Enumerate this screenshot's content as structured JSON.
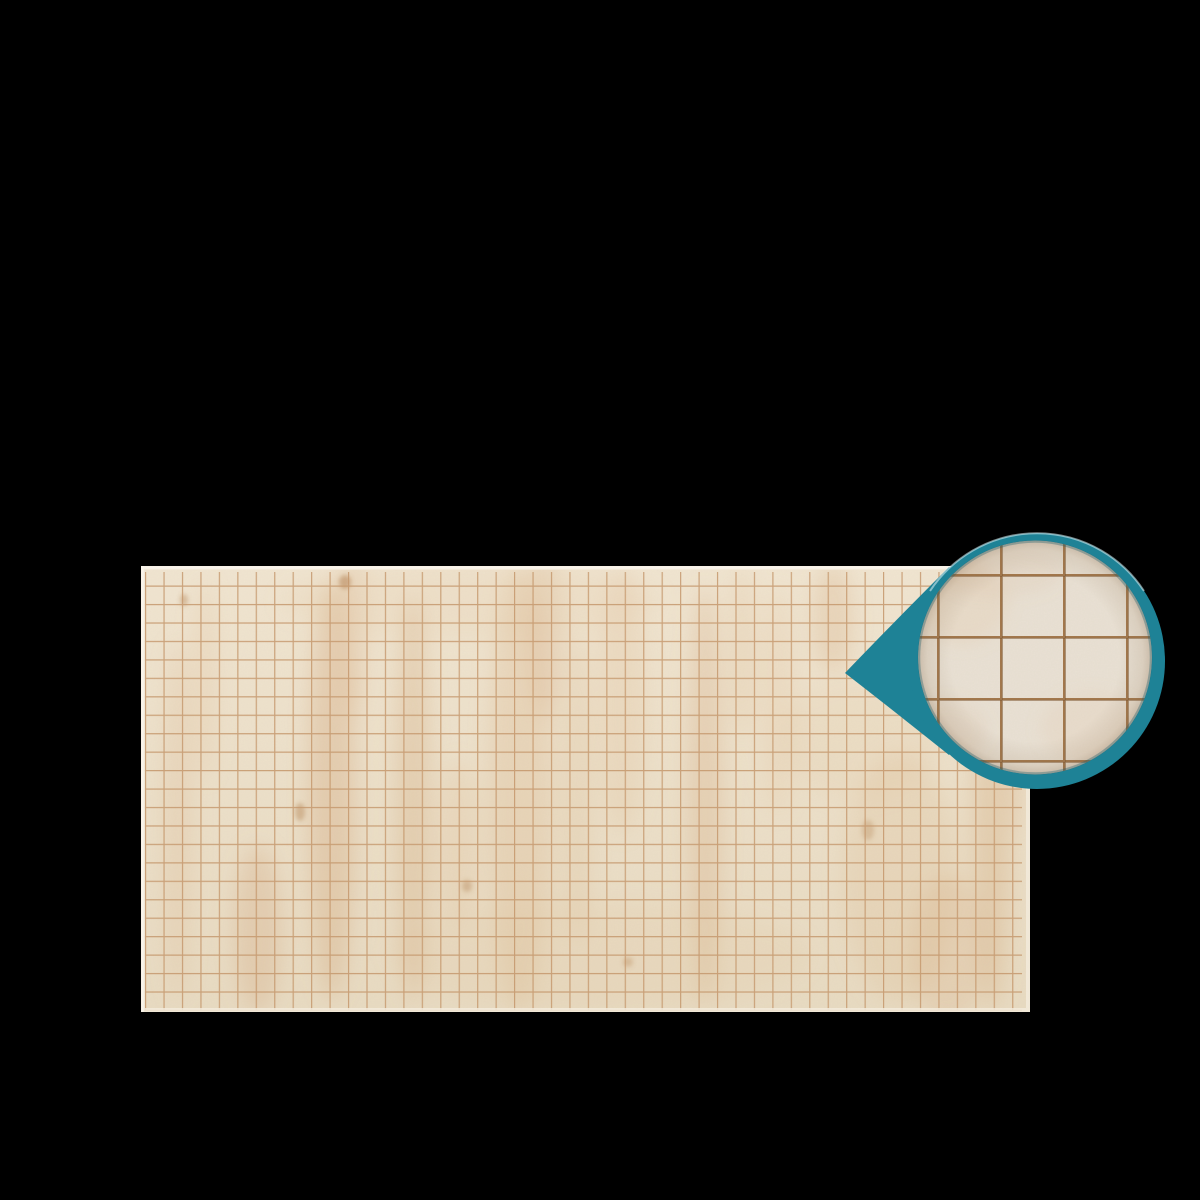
{
  "scene": {
    "description": "Cream parchment-style square-grid battle mat photographed on a black background, with a teal teardrop magnifier callout at the upper right showing a zoomed close-up of the grid squares",
    "background_color": "#000000"
  },
  "mat": {
    "grid": {
      "cell_px": 18.45,
      "columns": 48,
      "rows": 24,
      "line_color": "#C4976B",
      "surface_color": "#ECE0CA",
      "edge_color": "#F2EADB"
    }
  },
  "magnifier": {
    "ring_color": "#1E8296",
    "lens_surface_color": "#E9E1D4",
    "lens_line_color": "#9E7244",
    "cell_w_px": 63,
    "cell_h_px": 62,
    "visible_lens_columns": 5,
    "visible_lens_rows": 5
  },
  "colors": {
    "bg": "#000000",
    "mat_top": "#F0E5D1",
    "mat_bottom": "#E8DBC2",
    "mat_edge": "#F2EADB",
    "mat_edge_bright": "#FAF5EC",
    "grid_line": "#C4976B",
    "stain_warm": "#DFBB92",
    "stain_deep": "#D0A072",
    "knot": "#B3804E",
    "teal": "#1E8296",
    "teal_highlight": "#DFF2F5",
    "lens_base": "#E9E1D4",
    "lens_line": "#9E7244",
    "lens_line_dark": "#5F3C1C",
    "lens_rim": "#1E5E6E"
  }
}
